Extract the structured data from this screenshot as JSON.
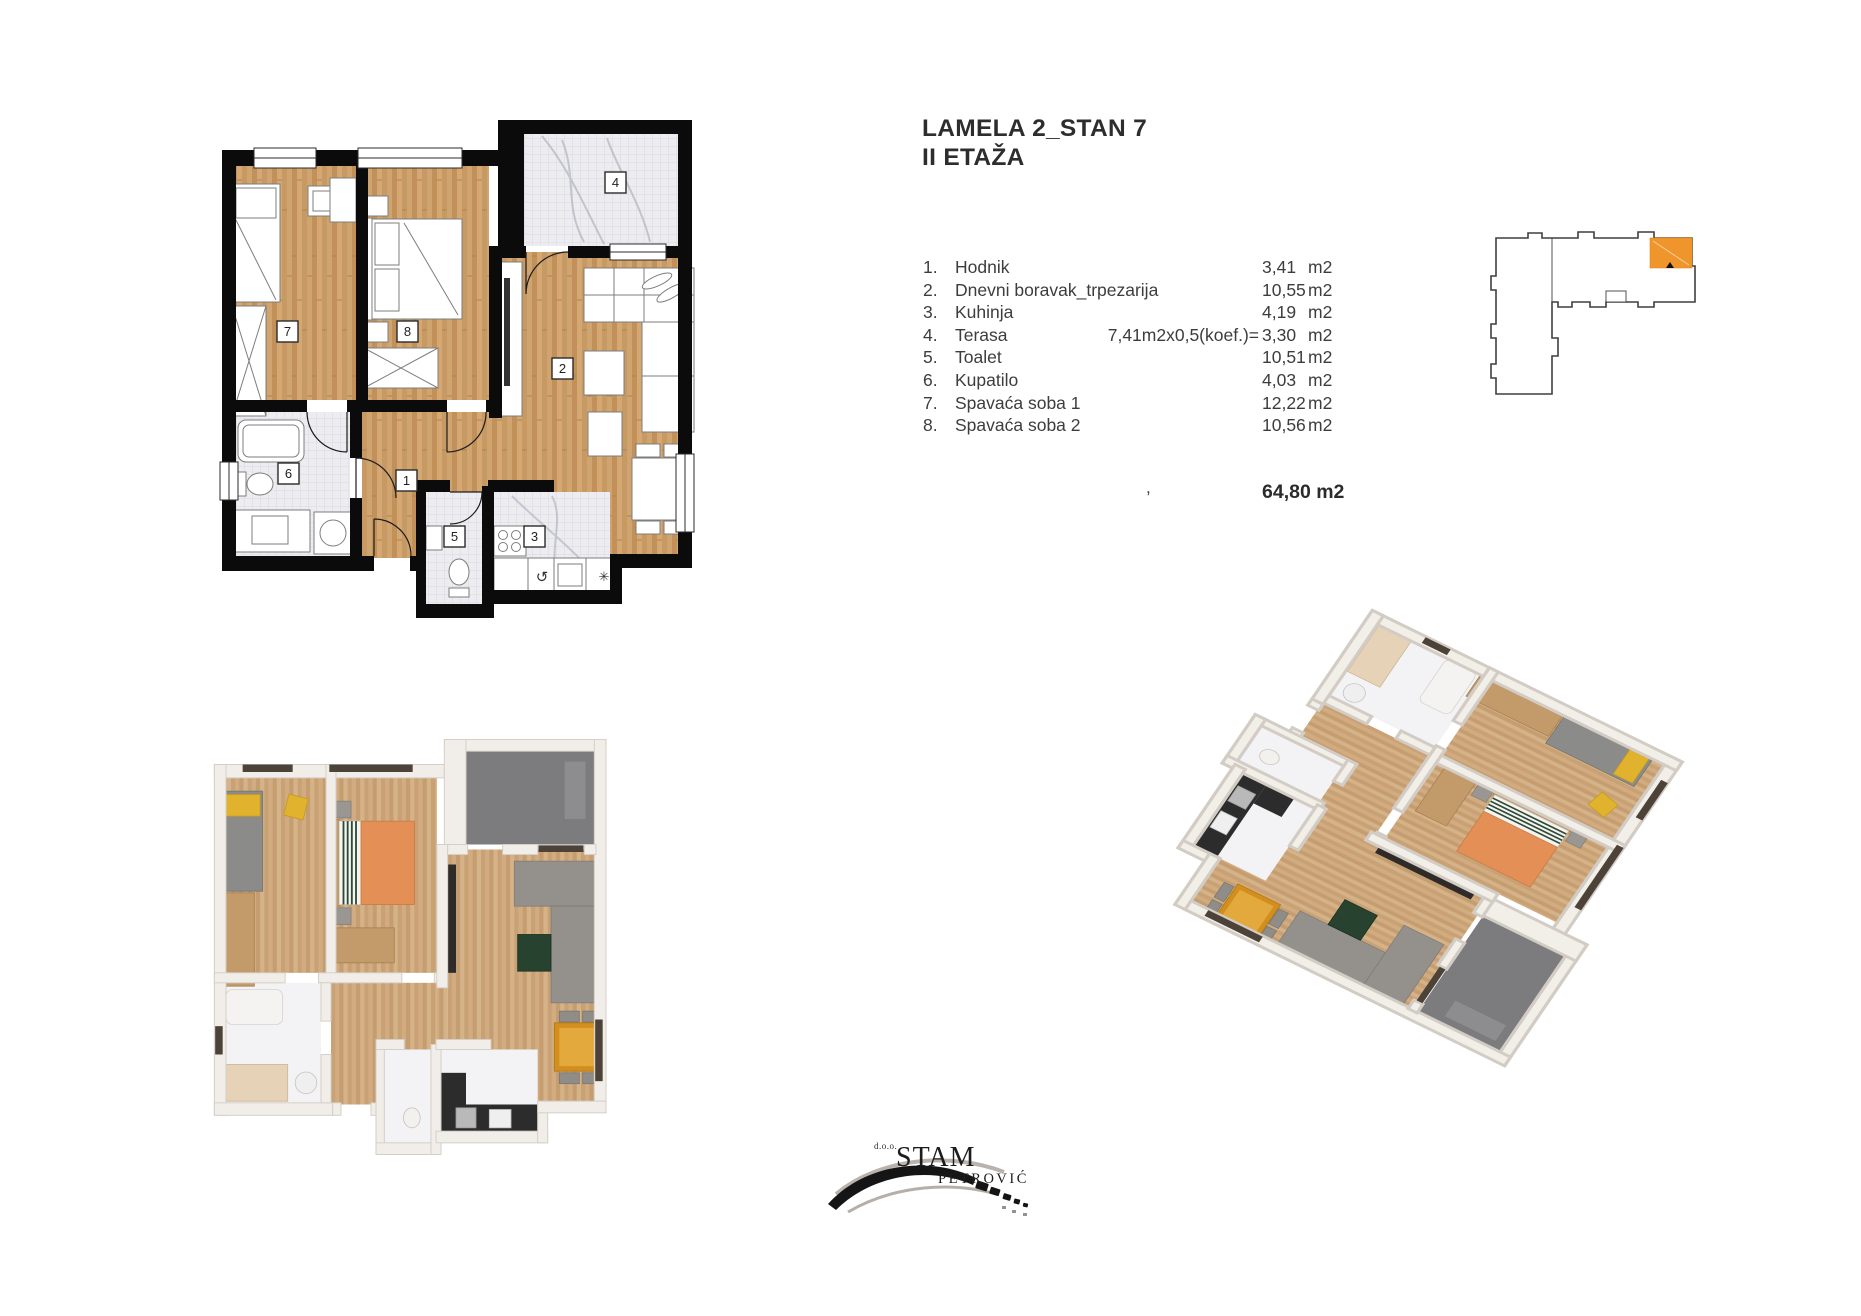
{
  "header": {
    "title": "LAMELA 2_STAN 7",
    "subtitle": "II ETAŽA"
  },
  "rooms": [
    {
      "no": "1.",
      "name": "Hodnik",
      "note": "",
      "area": "3,41",
      "unit": "m2"
    },
    {
      "no": "2.",
      "name": "Dnevni boravak_trpezarija",
      "note": "",
      "area": "10,55",
      "unit": "m2"
    },
    {
      "no": "3.",
      "name": "Kuhinja",
      "note": "",
      "area": "4,19",
      "unit": "m2"
    },
    {
      "no": "4.",
      "name": "Terasa",
      "note": "7,41m2x0,5(koef.)=",
      "area": "3,30",
      "unit": "m2"
    },
    {
      "no": "5.",
      "name": "Toalet",
      "note": "",
      "area": "10,51",
      "unit": "m2"
    },
    {
      "no": "6.",
      "name": "Kupatilo",
      "note": "",
      "area": "4,03",
      "unit": "m2"
    },
    {
      "no": "7.",
      "name": "Spavaća soba 1",
      "note": "",
      "area": "12,22",
      "unit": "m2"
    },
    {
      "no": "8.",
      "name": "Spavaća soba 2",
      "note": "",
      "area": "10,56",
      "unit": "m2"
    }
  ],
  "total": {
    "comma": ",",
    "value": "64,80 m2"
  },
  "plan2d": {
    "labels": {
      "r1": "1",
      "r2": "2",
      "r3": "3",
      "r4": "4",
      "r5": "5",
      "r6": "6",
      "r7": "7",
      "r8": "8"
    },
    "kitchen_icons": {
      "dishwasher": "↺",
      "freezer": "✳"
    }
  },
  "logo": {
    "prefix": "d.o.o.",
    "name": "STAM",
    "surname": "PETROVIĆ"
  },
  "colors": {
    "accent_orange": "#F0952B",
    "wall_black": "#0B0B0B",
    "wood": "#CDA06B",
    "wood_3d": "#CBA378",
    "tile": "#EDECF0",
    "terrace_gray": "#7C7C7E",
    "text_gray": "#3D3D3D"
  }
}
